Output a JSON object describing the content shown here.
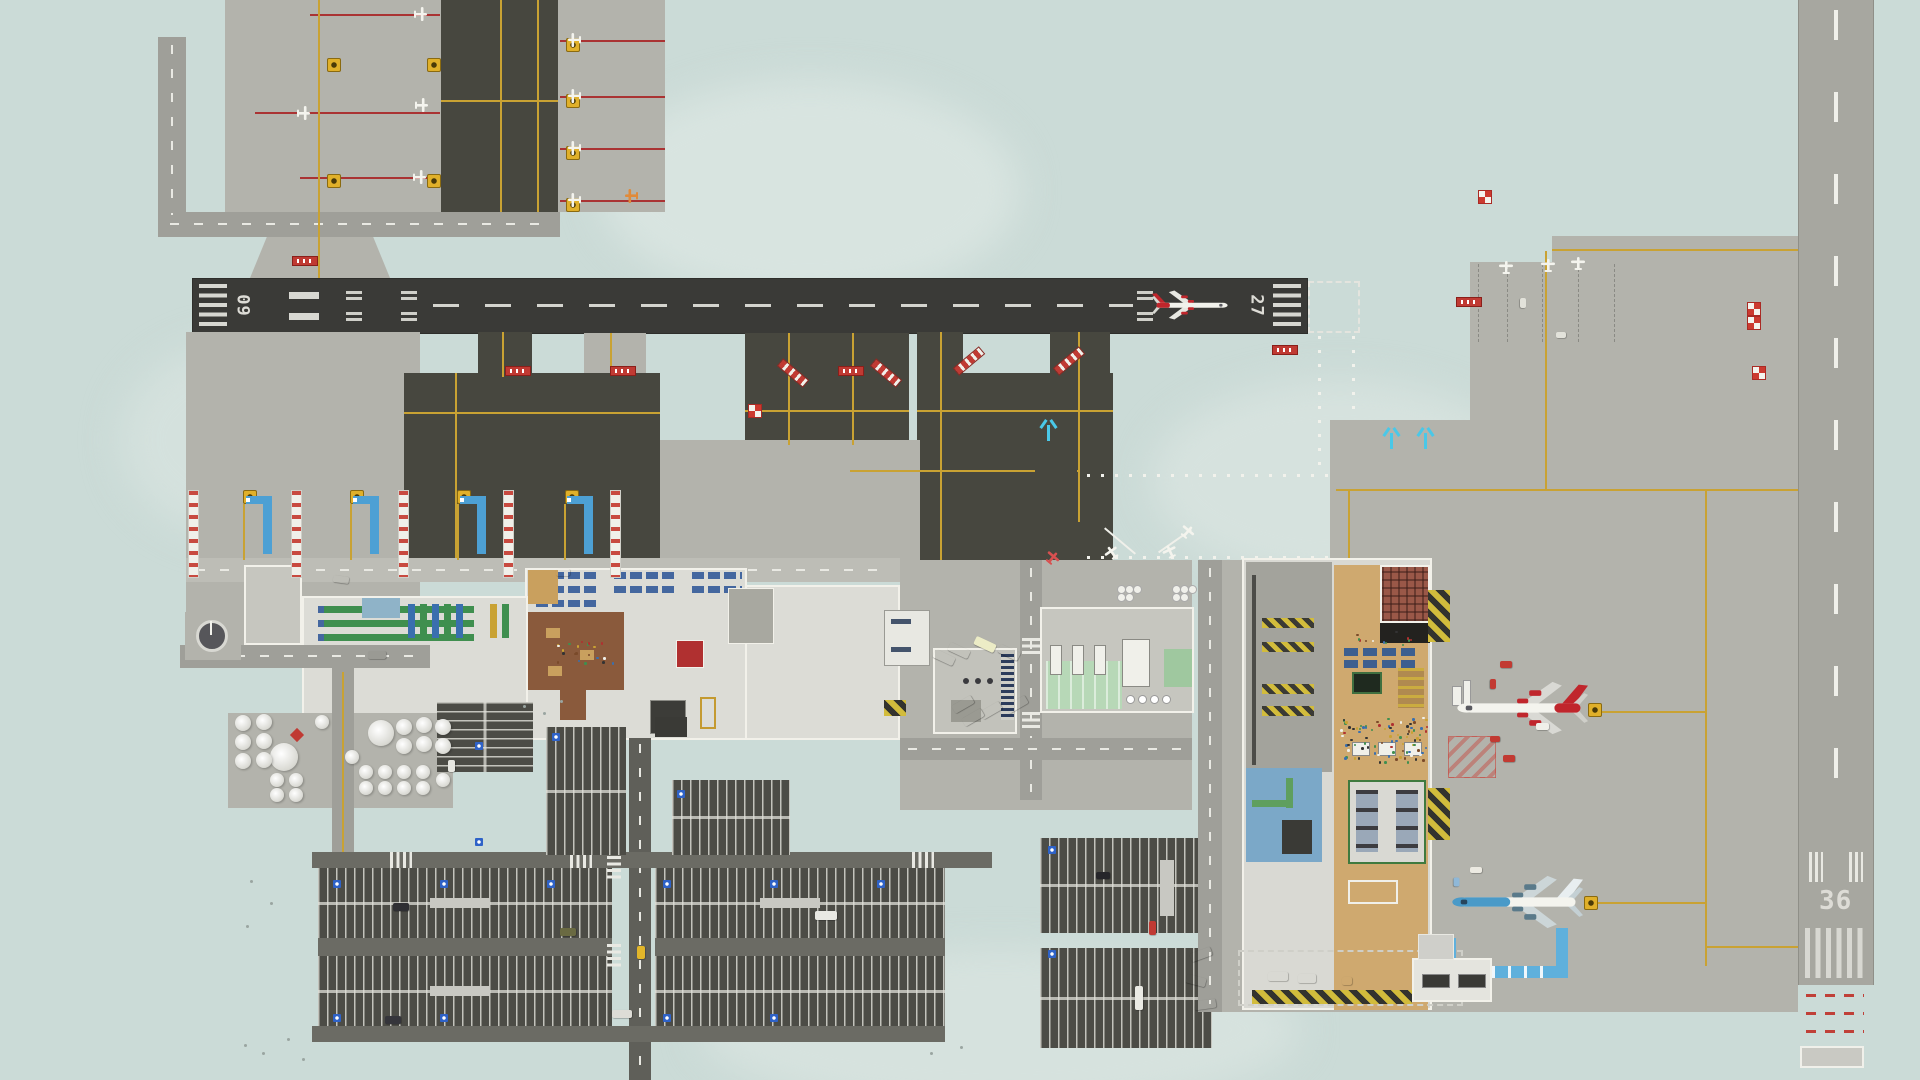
{
  "scene": {
    "name": "airport-top-down-overview",
    "style": "airport management simulation, top-down map view",
    "background_color": "#cbdbd7"
  },
  "palette": {
    "terrain": "#cbdbd7",
    "terrain_light": "#d8e4e0",
    "concrete_apron": "#b3b3ac",
    "asphalt_taxiway": "#47473f",
    "runway_main": "#3a3a37",
    "runway_crosswind": "#a7a7a0",
    "road": "#9f9f99",
    "parking_lot": "#4c4c46",
    "taxi_line_yellow": "#c9a233",
    "marking_white": "#e9e9e3",
    "stop_bar_red": "#c03a33",
    "jet_bridge_blue": "#4da0d4",
    "walkway_blue": "#5fb0dc",
    "deice_cyan": "#4ac8e8",
    "terminal_floor": "#dcdcd6",
    "wall_white": "#f2f1ea",
    "checkin_desk_green": "#3f8f4f",
    "seating_blue": "#44679f",
    "shop_floor_brown": "#8a5a3c",
    "concourse_tan": "#cfa96f",
    "restaurant_brick": "#9a5848",
    "food_court_black": "#23221f",
    "pool_blue": "#7ba8c8",
    "service_green": "#b7d8b7",
    "livery_red": "#c0262c",
    "livery_blue": "#4a9ac8"
  },
  "runways": {
    "main": {
      "id": "09/27",
      "left_label": "09",
      "right_label": "27",
      "orientation": "horizontal"
    },
    "crosswind": {
      "id": "36",
      "label": "36",
      "orientation": "vertical"
    }
  },
  "aircraft": {
    "on_runway": {
      "desc": "narrowbody airliner, white with red tail and engines, rolling east on runway 27"
    },
    "gate_north": {
      "desc": "widebody airliner, white with red tail, parked nose-west at gate"
    },
    "gate_south": {
      "desc": "widebody airliner, blue and white livery, parked nose-west at gate"
    }
  },
  "areas": [
    "ga-apron-northwest",
    "runway-09-27",
    "runway-36",
    "taxiway-network",
    "gate-stands-with-jet-bridges",
    "main-terminal",
    "east-terminal",
    "fuel-tank-farm",
    "public-parking-lots",
    "bus-plaza",
    "control-tower",
    "service-garage",
    "grass-tie-downs",
    "gate-apron-east",
    "service-yard"
  ],
  "objects": {
    "fuel_tanks": [
      [
        284,
        757,
        14
      ],
      [
        381,
        733,
        13
      ],
      [
        243,
        723,
        8
      ],
      [
        264,
        722,
        8
      ],
      [
        243,
        742,
        8
      ],
      [
        264,
        741,
        8
      ],
      [
        243,
        761,
        8
      ],
      [
        264,
        760,
        8
      ],
      [
        277,
        780,
        7
      ],
      [
        296,
        780,
        7
      ],
      [
        277,
        795,
        7
      ],
      [
        296,
        795,
        7
      ],
      [
        404,
        727,
        8
      ],
      [
        424,
        725,
        8
      ],
      [
        443,
        727,
        8
      ],
      [
        404,
        746,
        8
      ],
      [
        424,
        744,
        8
      ],
      [
        443,
        746,
        8
      ],
      [
        366,
        772,
        7
      ],
      [
        385,
        772,
        7
      ],
      [
        404,
        772,
        7
      ],
      [
        423,
        772,
        7
      ],
      [
        366,
        788,
        7
      ],
      [
        385,
        788,
        7
      ],
      [
        404,
        788,
        7
      ],
      [
        423,
        788,
        7
      ],
      [
        443,
        780,
        7
      ],
      [
        352,
        757,
        7
      ],
      [
        322,
        722,
        7
      ]
    ],
    "checker_markers": [
      [
        748,
        404
      ],
      [
        1478,
        190
      ],
      [
        1747,
        302
      ],
      [
        1747,
        316
      ],
      [
        1752,
        366
      ]
    ],
    "hold_signs": [
      [
        292,
        256
      ],
      [
        505,
        366
      ],
      [
        610,
        366
      ],
      [
        838,
        366
      ],
      [
        1272,
        345
      ],
      [
        1456,
        297
      ]
    ],
    "stand_signs": [
      [
        243,
        490
      ],
      [
        350,
        490
      ],
      [
        457,
        490
      ],
      [
        565,
        490
      ],
      [
        1588,
        703
      ],
      [
        1584,
        896
      ],
      [
        327,
        58
      ],
      [
        427,
        58
      ],
      [
        327,
        174
      ],
      [
        427,
        174
      ],
      [
        566,
        38
      ],
      [
        566,
        94
      ],
      [
        566,
        146
      ],
      [
        566,
        198
      ]
    ],
    "ladders": [
      [
        188,
        490
      ],
      [
        291,
        490
      ],
      [
        398,
        490
      ],
      [
        503,
        490
      ],
      [
        610,
        490
      ]
    ],
    "jet_bridges": [
      [
        263,
        496
      ],
      [
        370,
        496
      ],
      [
        477,
        496
      ],
      [
        584,
        496
      ]
    ],
    "cyan_marks": [
      [
        1390,
        433
      ],
      [
        1424,
        433
      ],
      [
        1047,
        425
      ]
    ],
    "ga_planes": [
      [
        420,
        14,
        90
      ],
      [
        421,
        105,
        90
      ],
      [
        419,
        177,
        90
      ],
      [
        303,
        113,
        90
      ],
      [
        575,
        40,
        -90
      ],
      [
        575,
        96,
        -90
      ],
      [
        575,
        148,
        -90
      ],
      [
        575,
        200,
        -90
      ],
      [
        632,
        196,
        -90,
        "#e08a3a"
      ],
      [
        1506,
        268,
        0
      ],
      [
        1548,
        266,
        0
      ],
      [
        1578,
        264,
        0
      ],
      [
        1112,
        553,
        -35
      ],
      [
        1170,
        552,
        -25
      ],
      [
        1187,
        532,
        40
      ],
      [
        1052,
        558,
        40,
        "#d85050"
      ]
    ],
    "handicap_badges": [
      [
        333,
        880
      ],
      [
        440,
        880
      ],
      [
        547,
        880
      ],
      [
        333,
        1014
      ],
      [
        440,
        1014
      ],
      [
        663,
        880
      ],
      [
        770,
        880
      ],
      [
        877,
        880
      ],
      [
        663,
        1014
      ],
      [
        770,
        1014
      ],
      [
        475,
        742
      ],
      [
        475,
        838
      ],
      [
        677,
        790
      ],
      [
        1048,
        846
      ],
      [
        1048,
        950
      ],
      [
        552,
        733
      ]
    ],
    "vehicles": [
      [
        393,
        903,
        16,
        8,
        0,
        "#2f2f33"
      ],
      [
        560,
        928,
        16,
        8,
        0,
        "#6a6a42"
      ],
      [
        815,
        911,
        22,
        9,
        0,
        "#e9e9e3"
      ],
      [
        385,
        1016,
        16,
        8,
        0,
        "#35353b"
      ],
      [
        612,
        1010,
        20,
        8,
        0,
        "#dddcd6"
      ],
      [
        1096,
        872,
        14,
        7,
        0,
        "#26262a"
      ],
      [
        1149,
        921,
        7,
        14,
        0,
        "#c03a33"
      ],
      [
        1135,
        986,
        8,
        24,
        0,
        "#eaeae4"
      ],
      [
        637,
        946,
        8,
        13,
        0,
        "#e2b62a"
      ],
      [
        948,
        646,
        22,
        9,
        25,
        "#ececе6"
      ],
      [
        974,
        640,
        22,
        9,
        25,
        "#ececc6"
      ],
      [
        998,
        648,
        22,
        9,
        25,
        "#ececе6"
      ],
      [
        933,
        653,
        22,
        9,
        25,
        "#ececе6"
      ],
      [
        952,
        700,
        22,
        9,
        -30,
        "#ececе6"
      ],
      [
        980,
        706,
        22,
        9,
        -30,
        "#ececе6"
      ],
      [
        1006,
        700,
        22,
        9,
        -30,
        "#ececе6"
      ],
      [
        962,
        713,
        22,
        9,
        -30,
        "#ececе6"
      ],
      [
        1268,
        972,
        20,
        9,
        0,
        "#ececе6"
      ],
      [
        1298,
        974,
        18,
        9,
        0,
        "#ececе6"
      ],
      [
        1342,
        977,
        10,
        8,
        0,
        "#ececе6"
      ],
      [
        1190,
        950,
        22,
        9,
        -20,
        "#ececе6"
      ],
      [
        1186,
        976,
        20,
        9,
        15,
        "#ececе6"
      ],
      [
        1194,
        1000,
        22,
        9,
        -8,
        "#ececе6"
      ],
      [
        1500,
        661,
        12,
        7,
        0,
        "#c23a32"
      ],
      [
        1488,
        681,
        10,
        6,
        90,
        "#c23a32"
      ],
      [
        1490,
        736,
        10,
        6,
        0,
        "#c23a32"
      ],
      [
        1503,
        755,
        12,
        7,
        0,
        "#c23a32"
      ],
      [
        1536,
        723,
        13,
        7,
        0,
        "#f0f0ea"
      ],
      [
        1470,
        867,
        12,
        6,
        0,
        "#eceae2"
      ],
      [
        1452,
        879,
        9,
        6,
        90,
        "#8fb8d8"
      ],
      [
        368,
        651,
        18,
        8,
        0,
        "#9a9a94"
      ],
      [
        333,
        576,
        16,
        7,
        8,
        "#ececе6"
      ],
      [
        556,
        569,
        14,
        7,
        0,
        "#ececе6"
      ],
      [
        448,
        760,
        7,
        12,
        0,
        "#e8e8e2"
      ],
      [
        1518,
        300,
        10,
        6,
        90,
        "#e2e2da"
      ],
      [
        1556,
        332,
        10,
        6,
        0,
        "#e2e2da"
      ]
    ],
    "stacks": [
      [
        1117,
        585
      ],
      [
        1172,
        585
      ]
    ],
    "specks": [
      [
        244,
        1044
      ],
      [
        262,
        1052
      ],
      [
        287,
        1038
      ],
      [
        302,
        1058
      ],
      [
        523,
        705
      ],
      [
        543,
        712
      ],
      [
        560,
        700
      ],
      [
        250,
        880
      ],
      [
        270,
        902
      ],
      [
        246,
        925
      ],
      [
        960,
        1046
      ],
      [
        930,
        1052
      ]
    ],
    "stop_bars": [
      [
        776,
        368,
        40
      ],
      [
        869,
        368,
        40
      ],
      [
        952,
        356,
        -40
      ],
      [
        1052,
        356,
        -40
      ]
    ],
    "crowd_zones": [
      {
        "x": 1340,
        "y": 716,
        "w": 86,
        "h": 46,
        "n": 90
      },
      {
        "x": 556,
        "y": 640,
        "w": 60,
        "h": 24,
        "n": 22
      },
      {
        "x": 1350,
        "y": 630,
        "w": 60,
        "h": 14,
        "n": 12
      }
    ]
  }
}
